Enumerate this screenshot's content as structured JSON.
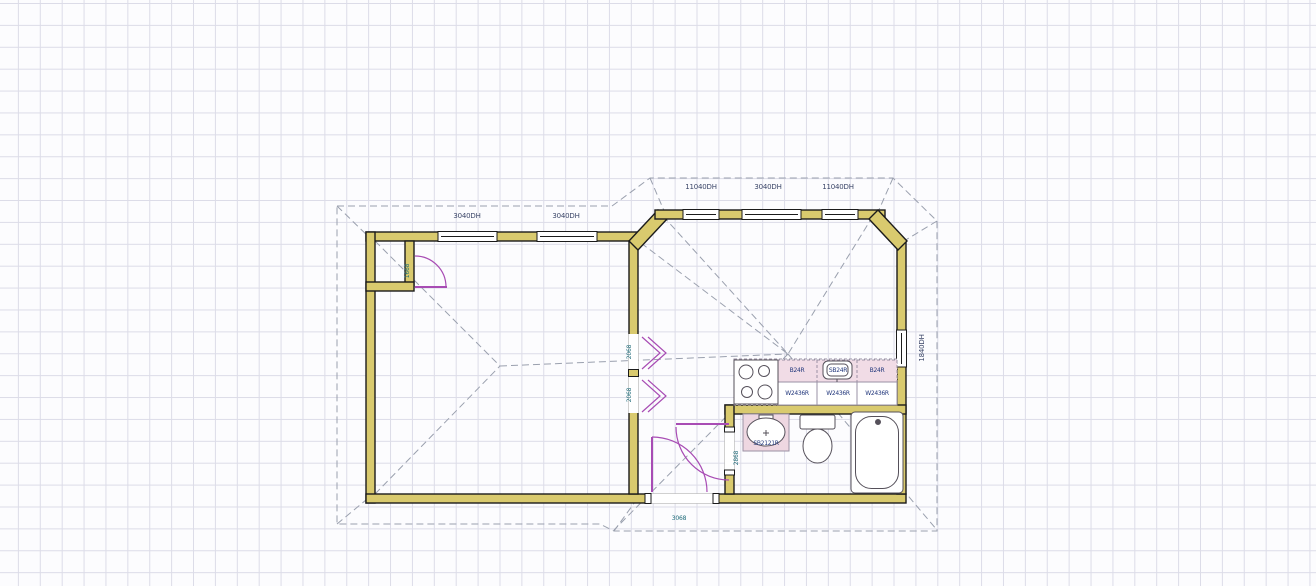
{
  "app": {
    "view_name": "floor-plan-drawing-canvas"
  },
  "colors": {
    "wall_fill": "#d9ca6e",
    "wall_outline": "#1b1b1b",
    "door_symbol": "#a84cb4",
    "roof_dashed": "#9aa0ae",
    "grid_line": "#dcdce8",
    "cabinet_fill": "#f1dce6",
    "label_text": "#3b4668",
    "door_label_text": "#1e6a78",
    "cabinet_label_text": "#23387c"
  },
  "plan": {
    "windows": {
      "left": [
        "3040DH",
        "3040DH"
      ],
      "bay": [
        "11040DH",
        "3040DH",
        "11040DH"
      ],
      "right": "1840DH"
    },
    "doors": {
      "closet": "1668",
      "bifolds": [
        "2068",
        "2068"
      ],
      "bathroom": "2868",
      "front": "3068"
    },
    "kitchen": {
      "base": [
        "B24R",
        "SB24R",
        "B24R"
      ],
      "wall": [
        "W2436R",
        "W2436R",
        "W2436R"
      ]
    },
    "bathroom": {
      "vanity": "SB2121R"
    }
  }
}
